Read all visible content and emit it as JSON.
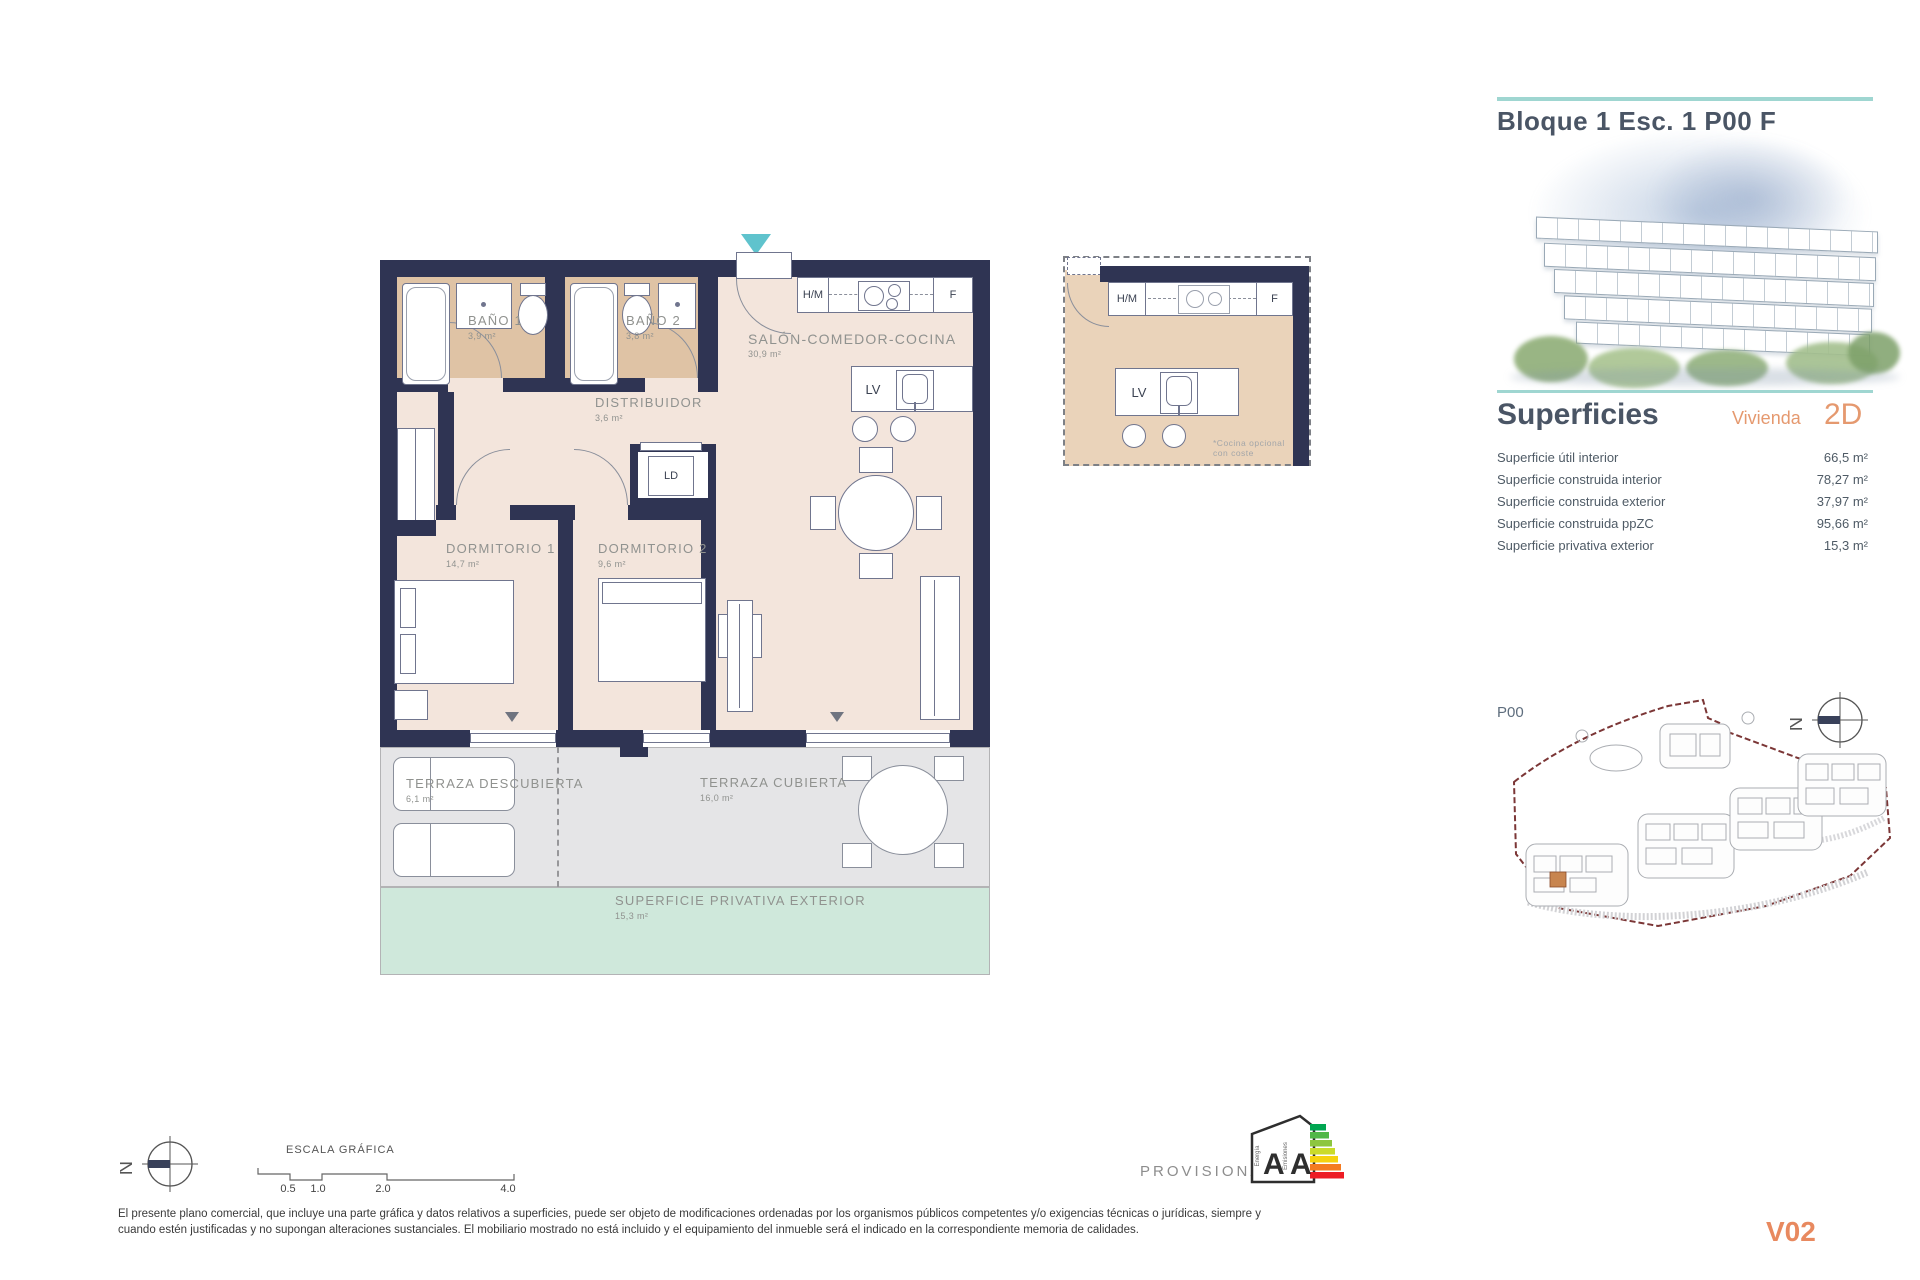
{
  "north_letter": "N",
  "header": {
    "title": "Bloque 1 Esc. 1 P00 F"
  },
  "superficies": {
    "title": "Superficies",
    "vivienda_label": "Vivienda",
    "vivienda_code": "2D",
    "rows": [
      {
        "label": "Superficie útil interior",
        "value": "66,5 m²"
      },
      {
        "label": "Superficie construida interior",
        "value": "78,27 m²"
      },
      {
        "label": "Superficie construida exterior",
        "value": "37,97 m²"
      },
      {
        "label": "Superficie construida ppZC",
        "value": "95,66 m²"
      },
      {
        "label": "Superficie privativa exterior",
        "value": "15,3 m²"
      }
    ]
  },
  "site": {
    "floor_label": "P00"
  },
  "floor_plan": {
    "rooms": {
      "bano1": {
        "name": "BAÑO 1",
        "area": "3,9 m²"
      },
      "bano2": {
        "name": "BAÑO 2",
        "area": "3,8 m²"
      },
      "salon": {
        "name": "SALÓN-COMEDOR-COCINA",
        "area": "30,9 m²"
      },
      "distribuidor": {
        "name": "DISTRIBUIDOR",
        "area": "3,6 m²"
      },
      "dormitorio1": {
        "name": "DORMITORIO 1",
        "area": "14,7 m²"
      },
      "dormitorio2": {
        "name": "DORMITORIO 2",
        "area": "9,6 m²"
      },
      "terraza_descubierta": {
        "name": "TERRAZA DESCUBIERTA",
        "area": "6,1 m²"
      },
      "terraza_cubierta": {
        "name": "TERRAZA CUBIERTA",
        "area": "16,0 m²"
      },
      "privativa": {
        "name": "SUPERFICIE PRIVATIVA EXTERIOR",
        "area": "15,3 m²"
      }
    },
    "fixtures": {
      "hm": "H/M",
      "f": "F",
      "lv": "LV",
      "ld": "LD"
    },
    "kitchen_note": {
      "line1": "*Cocina opcional",
      "line2": "con coste"
    }
  },
  "footer": {
    "scale_title": "ESCALA GRÁFICA",
    "scale_ticks": [
      "0.5",
      "1.0",
      "2.0",
      "4.0"
    ],
    "provisional": "PROVISIONAL",
    "energy": {
      "letter1": "A",
      "letter2": "A",
      "axis1": "Energía",
      "axis2": "Emisiones"
    },
    "disclaimer_line1": "El presente plano comercial, que incluye una parte gráfica y datos relativos a superficies, puede ser objeto de modificaciones ordenadas por los organismos públicos competentes y/o exigencias técnicas o jurídicas, siempre y",
    "disclaimer_line2": "cuando estén justificadas y no supongan alteraciones sustanciales. El mobiliario mostrado no está incluido y el equipamiento del inmueble será el indicado en la correspondiente memoria de calidades.",
    "version": "V02"
  }
}
